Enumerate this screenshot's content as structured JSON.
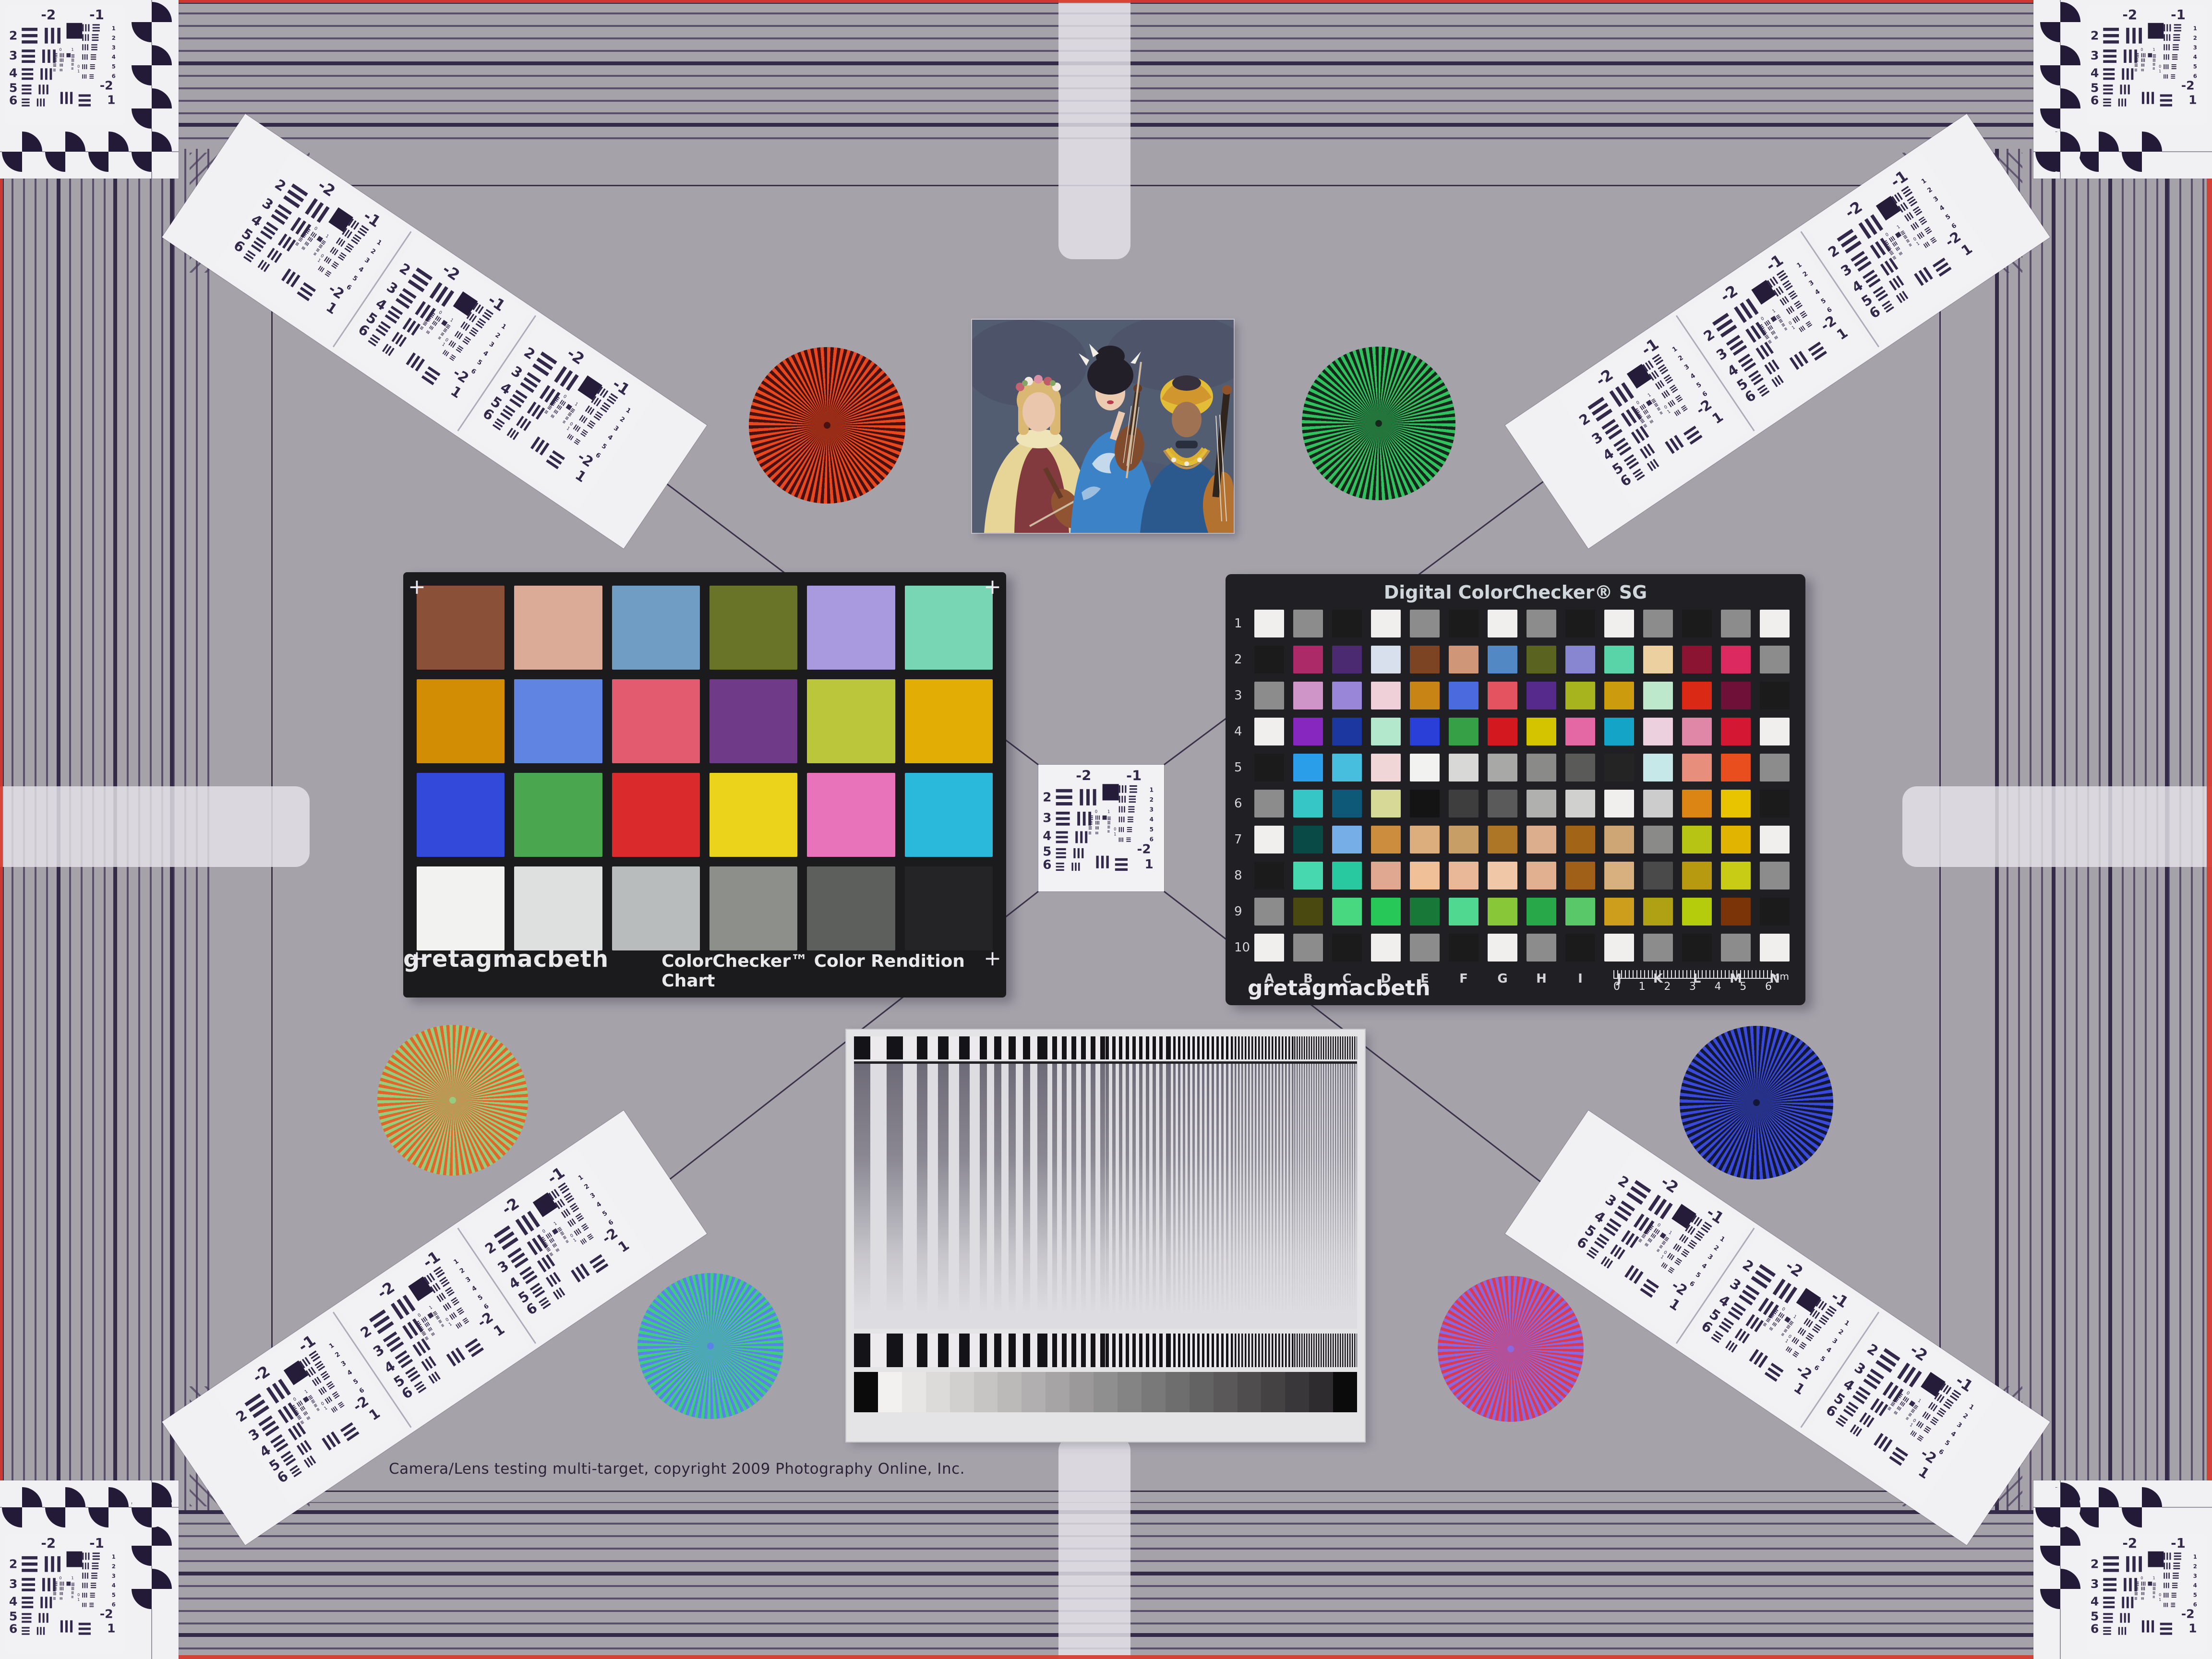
{
  "theme": {
    "background": "#a5a2aa",
    "grating_line": "#43385c",
    "frame_line": "#39314a",
    "card_white": "#f1f0f3",
    "marking_ink": "#32284a",
    "red_edge": "#d73a2e",
    "colorchecker_black": "#1b1b1d",
    "sg_black": "#202024"
  },
  "footer": {
    "copyright": "Camera/Lens testing multi-target, copyright 2009 Photography Online, Inc."
  },
  "colorchecker": {
    "brand": "gretagmacbeth",
    "title": "ColorChecker™ Color Rendition Chart",
    "corner_mark": "+",
    "patches": [
      "#8a5138",
      "#dcab97",
      "#6f9dc4",
      "#6a7429",
      "#a99ae0",
      "#79d6b5",
      "#d28d04",
      "#5f84e2",
      "#e25b6e",
      "#6f3a88",
      "#bcc63a",
      "#e2ad04",
      "#3349da",
      "#4aa64f",
      "#da2a2c",
      "#ead31a",
      "#e873bb",
      "#2ab9da",
      "#f2f2f0",
      "#dedfdf",
      "#b9bcbc",
      "#8d8f8b",
      "#5d5f5d",
      "#242426"
    ]
  },
  "sg": {
    "title": "Digital ColorChecker® SG",
    "brand": "gretagmacbeth",
    "columns": [
      "A",
      "B",
      "C",
      "D",
      "E",
      "F",
      "G",
      "H",
      "I",
      "J",
      "K",
      "L",
      "M",
      "N"
    ],
    "row_labels": [
      "1",
      "2",
      "3",
      "4",
      "5",
      "6",
      "7",
      "8",
      "9",
      "10"
    ],
    "ruler_labels": [
      "0",
      "1",
      "2",
      "3",
      "4",
      "5",
      "6"
    ],
    "ruler_unit": "mm",
    "patches": [
      [
        "#f0efed",
        "#8c8c8c",
        "#1b1b1b",
        "#f0efed",
        "#8c8c8c",
        "#1b1b1b",
        "#f0efed",
        "#8c8c8c",
        "#1b1b1b",
        "#f0efed",
        "#8c8c8c",
        "#1b1b1b",
        "#8c8c8c",
        "#f0efed"
      ],
      [
        "#1b1b1b",
        "#ad2a68",
        "#4c2a72",
        "#d8e0ee",
        "#7c4422",
        "#d09678",
        "#5288c4",
        "#5a6420",
        "#8886d0",
        "#58d4a8",
        "#ecd0a0",
        "#8a1432",
        "#dc2a60",
        "#8c8c8c"
      ],
      [
        "#8c8c8c",
        "#d095c8",
        "#9a86d8",
        "#f0d0d8",
        "#c88414",
        "#4a6ade",
        "#e45460",
        "#562a8c",
        "#a8b41e",
        "#cc9c0e",
        "#bee8cc",
        "#da2a16",
        "#6e1038",
        "#1b1b1b"
      ],
      [
        "#f0efed",
        "#8826c0",
        "#1c38a0",
        "#b4e8cc",
        "#2a3ed8",
        "#36a046",
        "#d41820",
        "#d4c400",
        "#e468a4",
        "#14a4c8",
        "#ecd0de",
        "#e086a6",
        "#d41834",
        "#f0efed"
      ],
      [
        "#1b1b1b",
        "#2a9ee8",
        "#48bede",
        "#f0d6d6",
        "#f2f2f0",
        "#d8d8d6",
        "#a8a8a6",
        "#8a8a88",
        "#5a5a58",
        "#242424",
        "#c6e8e8",
        "#e88e7c",
        "#e84e1e",
        "#8c8c8c"
      ],
      [
        "#8c8c8c",
        "#36c6c6",
        "#0e5878",
        "#d6da96",
        "#141414",
        "#3e3e3e",
        "#5a5a5a",
        "#b0b0ae",
        "#d0d0ce",
        "#f0efed",
        "#cccccc",
        "#dc8414",
        "#e8c400",
        "#1b1b1b"
      ],
      [
        "#f0efed",
        "#0a4a46",
        "#76aee8",
        "#cc8e3e",
        "#dcae7e",
        "#c69e66",
        "#ac7626",
        "#dcae8e",
        "#a26416",
        "#cea676",
        "#8a8a88",
        "#b8c414",
        "#e0b400",
        "#f0efed"
      ],
      [
        "#1b1b1b",
        "#48d8b0",
        "#28c8a0",
        "#e0a890",
        "#f0c098",
        "#e8b898",
        "#f0c8a8",
        "#e0b090",
        "#a06018",
        "#d8b080",
        "#4a4a4a",
        "#b89a10",
        "#c8cc14",
        "#8c8c8c"
      ],
      [
        "#8c8c8c",
        "#4a4a10",
        "#48d880",
        "#28c858",
        "#187838",
        "#50d890",
        "#88c838",
        "#28a848",
        "#58c868",
        "#cc9e1c",
        "#b0a014",
        "#b4cc0c",
        "#7a3408",
        "#1b1b1b"
      ],
      [
        "#f0efed",
        "#8c8c8c",
        "#1b1b1b",
        "#f0efed",
        "#8c8c8c",
        "#1b1b1b",
        "#f0efed",
        "#8c8c8c",
        "#1b1b1b",
        "#f0efed",
        "#8c8c8c",
        "#1b1b1b",
        "#8c8c8c",
        "#f0efed"
      ]
    ]
  },
  "usaf": {
    "top": [
      "-2",
      "-1"
    ],
    "left": [
      "2",
      "3",
      "4",
      "5",
      "6"
    ],
    "right": [
      "1",
      "2",
      "3",
      "4",
      "5",
      "6"
    ],
    "bottom": [
      "-2",
      "1"
    ],
    "micro": [
      "0",
      "1"
    ]
  },
  "stars": [
    {
      "name": "red-star",
      "c1": "#e8481e",
      "c2": "#48100f"
    },
    {
      "name": "green-star",
      "c1": "#30c25e",
      "c2": "#15271a"
    },
    {
      "name": "gold-star",
      "c1": "#e0662a",
      "c2": "#96cc7e"
    },
    {
      "name": "blue-star",
      "c1": "#3a4ad8",
      "c2": "#121736"
    },
    {
      "name": "teal-star",
      "c1": "#3ecd80",
      "c2": "#5a82e8"
    },
    {
      "name": "magenta-star",
      "c1": "#d93a52",
      "c2": "#8a68e0"
    }
  ],
  "sweep": {
    "bar_dark": "#141418",
    "bar_light": "#eceaed",
    "sine_line": "#6e6b78",
    "sine_bg": "#dddce0",
    "segment_bar_widths": [
      34,
      22,
      15,
      10,
      7,
      5,
      3.5,
      2.5
    ],
    "wedge_steps": 19,
    "wedge_from": "#f2f1ef",
    "wedge_to": "#2e2c2e",
    "wedge_end": "#0b0b0c"
  }
}
